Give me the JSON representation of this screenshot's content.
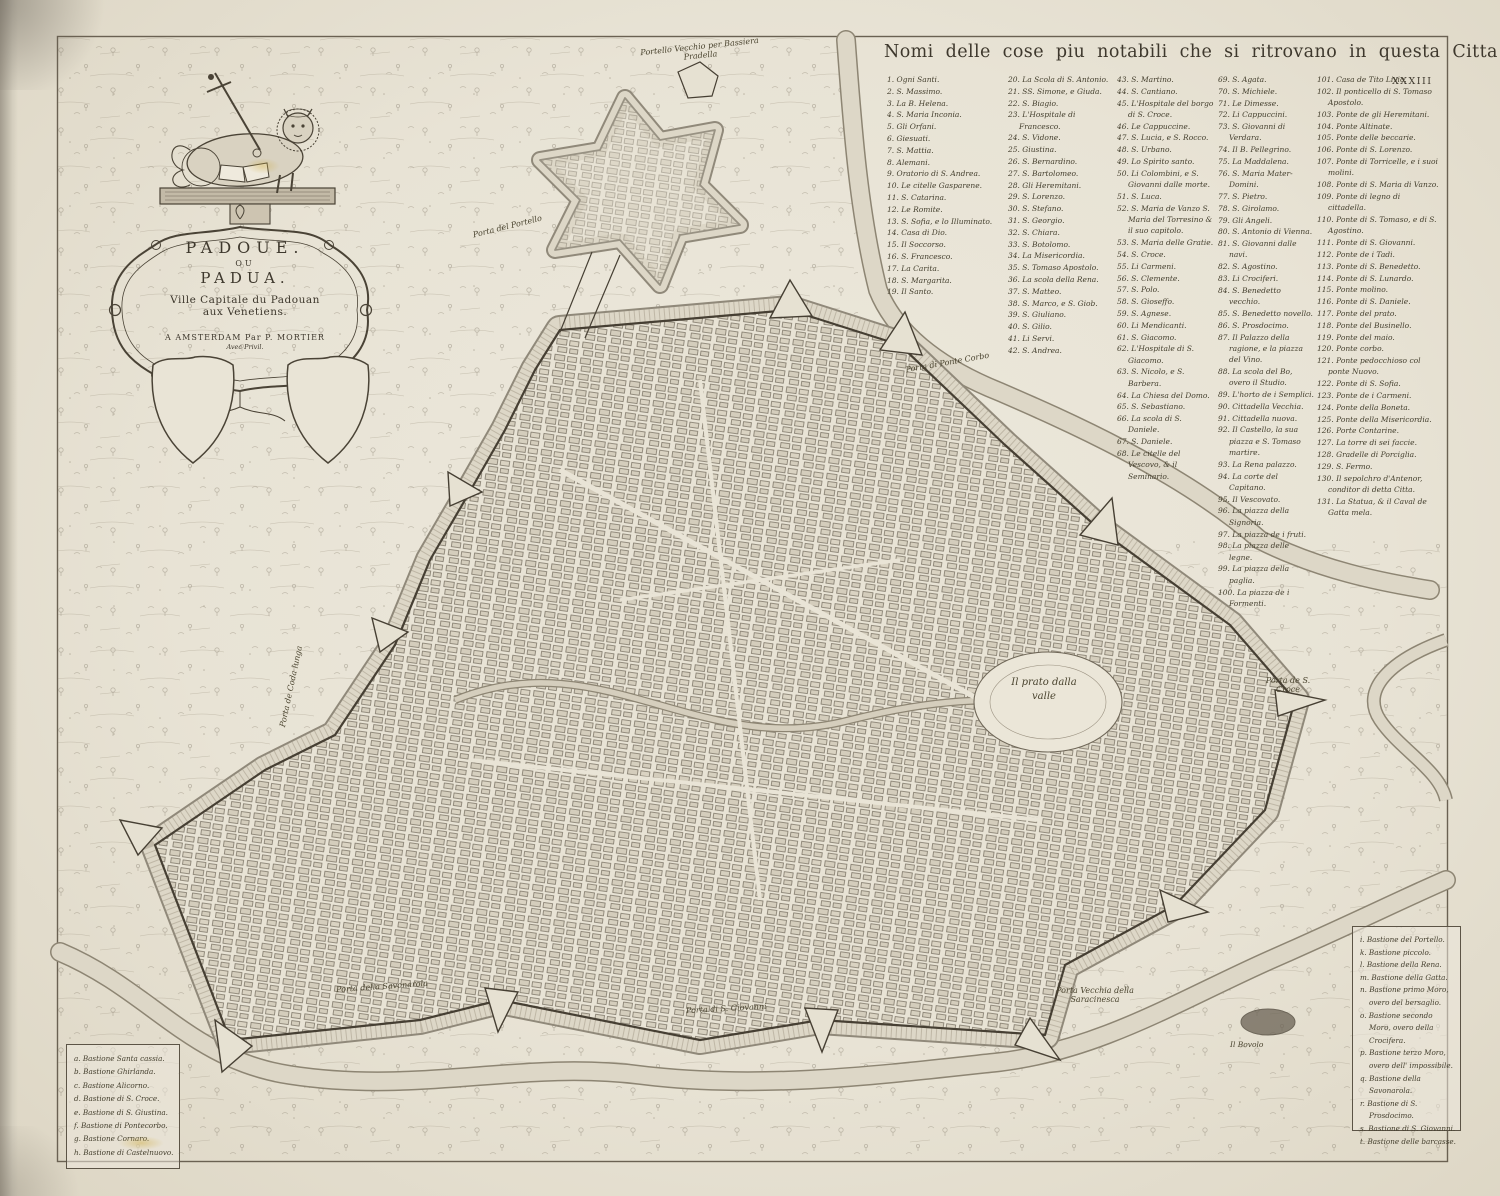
{
  "page": {
    "number": "XXXIII"
  },
  "colors": {
    "paper": "#e9e4d6",
    "ink": "#3e382d",
    "light_ink": "#8d8371",
    "stain": "#cdaa3c"
  },
  "cartouche": {
    "title_line1": "PADOUE.",
    "title_line2": "OU",
    "title_line3": "PADUA.",
    "subtitle_line1": "Ville Capitale du Padouan",
    "subtitle_line2": "aux Venetiens.",
    "imprint": "A AMSTERDAM Par P. MORTIER",
    "privilege": "Avec Privil."
  },
  "legend": {
    "title": "Nomi delle cose piu notabili che si ritrovano in questa Citta",
    "columns": [
      [
        "1. Ogni Santi.",
        "2. S. Massimo.",
        "3. La B. Helena.",
        "4. S. Maria Inconia.",
        "5. Gli Orfani.",
        "6. Giesuati.",
        "7. S. Mattia.",
        "8. Alemani.",
        "9. Oratorio di S. Andrea.",
        "10. Le citelle Gasparene.",
        "11. S. Catarina.",
        "12. Le Romite.",
        "13. S. Sofia, e lo Illuminato.",
        "14. Casa di Dio.",
        "15. Il Soccorso.",
        "16. S. Francesco.",
        "17. La Carita.",
        "18. S. Margarita.",
        "19. Il Santo."
      ],
      [
        "20. La Scola di S. Antonio.",
        "21. SS. Simone, e Giuda.",
        "22. S. Biagio.",
        "23. L'Hospitale di Francesco.",
        "24. S. Vidone.",
        "25. Giustina.",
        "26. S. Bernardino.",
        "27. S. Bartolomeo.",
        "28. Gli Heremitani.",
        "29. S. Lorenzo.",
        "30. S. Stefano.",
        "31. S. Georgio.",
        "32. S. Chiara.",
        "33. S. Botolomo.",
        "34. La Misericordia.",
        "35. S. Tomaso Apostolo.",
        "36. La scola della Rena.",
        "37. S. Matteo.",
        "38. S. Marco, e S. Giob.",
        "39. S. Giuliano.",
        "40. S. Gilio.",
        "41. Li Servi.",
        "42. S. Andrea."
      ],
      [
        "43. S. Martino.",
        "44. S. Cantiano.",
        "45. L'Hospitale del borgo di S. Croce.",
        "46. Le Cappuccine.",
        "47. S. Lucia, e S. Rocco.",
        "48. S. Urbano.",
        "49. Lo Spirito santo.",
        "50. Li Colombini, e S. Giovanni dalle morte.",
        "51. S. Luca.",
        "52. S. Maria de Vanzo S. Maria del Torresino & il suo capitolo.",
        "53. S. Maria delle Gratie.",
        "54. S. Croce.",
        "55. Li Carmeni.",
        "56. S. Clemente.",
        "57. S. Polo.",
        "58. S. Gioseffo.",
        "59. S. Agnese.",
        "60. Li Mendicanti.",
        "61. S. Giacomo.",
        "62. L'Hospitale di S. Giacomo.",
        "63. S. Nicolo, e S. Barbera.",
        "64. La Chiesa del Domo.",
        "65. S. Sebastiano.",
        "66. La scola di S. Daniele.",
        "67. S. Daniele.",
        "68. Le citelle del Vescovo, & il Seminario."
      ],
      [
        "69. S. Agata.",
        "70. S. Michiele.",
        "71. Le Dimesse.",
        "72. Li Cappuccini.",
        "73. S. Giovanni di Verdara.",
        "74. Il B. Pellegrino.",
        "75. La Maddalena.",
        "76. S. Maria Mater-Domini.",
        "77. S. Pietro.",
        "78. S. Girolamo.",
        "79. Gli Angeli.",
        "80. S. Antonio di Vienna.",
        "81. S. Giovanni dalle navi.",
        "82. S. Agostino.",
        "83. Li Crociferi.",
        "84. S. Benedetto vecchio.",
        "85. S. Benedetto novello.",
        "86. S. Prosdocimo.",
        "87. Il Palazzo della ragione, e la piazza del Vino.",
        "88. La scola del Bo, overo il Studio.",
        "89. L'horto de i Semplici.",
        "90. Cittadella Vecchia.",
        "91. Cittadella nuova.",
        "92. Il Castello, la sua piazza e S. Tomaso martire.",
        "93. La Rena palazzo.",
        "94. La corte del Capitano.",
        "95. Il Vescovato.",
        "96. La piazza della Signoria.",
        "97. La piazza de i fruti.",
        "98. La piazza delle legne.",
        "99. La piazza della paglia.",
        "100. La piazza de i Formenti."
      ],
      [
        "101. Casa de Tito Livio.",
        "102. Il ponticello di S. Tomaso Apostolo.",
        "103. Ponte de gli Heremitani.",
        "104. Ponte Altinate.",
        "105. Ponte delle beccarie.",
        "106. Ponte di S. Lorenzo.",
        "107. Ponte di Torricelle, e i suoi molini.",
        "108. Ponte di S. Maria di Vanzo.",
        "109. Ponte di legno di cittadella.",
        "110. Ponte di S. Tomaso, e di S. Agostino.",
        "111. Ponte di S. Giovanni.",
        "112. Ponte de i Tadi.",
        "113. Ponte di S. Benedetto.",
        "114. Ponte di S. Lunardo.",
        "115. Ponte molino.",
        "116. Ponte di S. Daniele.",
        "117. Ponte del prato.",
        "118. Ponte del Businello.",
        "119. Ponte del maio.",
        "120. Ponte corbo.",
        "121. Ponte pedocchioso col ponte Nuovo.",
        "122. Ponte di S. Sofia.",
        "123. Ponte de i Carmeni.",
        "124. Ponte della Boneta.",
        "125. Ponte della Misericordia.",
        "126. Porte Contarine.",
        "127. La torre di sei faccie.",
        "128. Gradelle di Porciglia.",
        "129. S. Fermo.",
        "130. Il sepolchro d'Antenor, conditor di detta Citta.",
        "131. La Statua, & il Caval de Gatta mela."
      ]
    ]
  },
  "keys": {
    "left": {
      "items": [
        "a. Bastione Santa cassia.",
        "b. Bastione Ghirlanda.",
        "c. Bastione Alicorno.",
        "d. Bastione di S. Croce.",
        "e. Bastione di S. Giustina.",
        "f. Bastione di Pontecorbo.",
        "g. Bastione Cornaro.",
        "h. Bastione di Castelnuovo."
      ]
    },
    "right": {
      "items": [
        "i. Bastione del Portello.",
        "k. Bastione piccolo.",
        "l. Bastione della Rena.",
        "m. Bastione della Gatta.",
        "n. Bastione primo Moro, overo del bersaglio.",
        "o. Bastione secondo Moro, overo della Crocifera.",
        "p. Bastione terzo Moro, overo dell' impossibile.",
        "q. Bastione della Savonarola.",
        "r. Bastione di S. Prosdocimo.",
        "s. Bastione di S. Giovanni.",
        "t. Bastione delle barcasse."
      ]
    }
  },
  "map_labels": {
    "portello_vecchio": "Portello Vecchio per Bassiera Pradella",
    "porta_portello": "Porta del Portello",
    "porta_ponte_corbo": "Porta di Ponte Corbo",
    "porta_codalunga": "Porta de Coda lunga",
    "porta_s_croce": "Porta de S. Croce",
    "prato_della_valle": "Il prato dalla valle",
    "porta_savonarola": "Porta della Savonarola",
    "porta_s_giovanni": "Porta di S. Giovanni",
    "porta_saracinesca": "Porta Vecchia della Saracinesca",
    "il_bovolo": "Il Bovolo"
  }
}
